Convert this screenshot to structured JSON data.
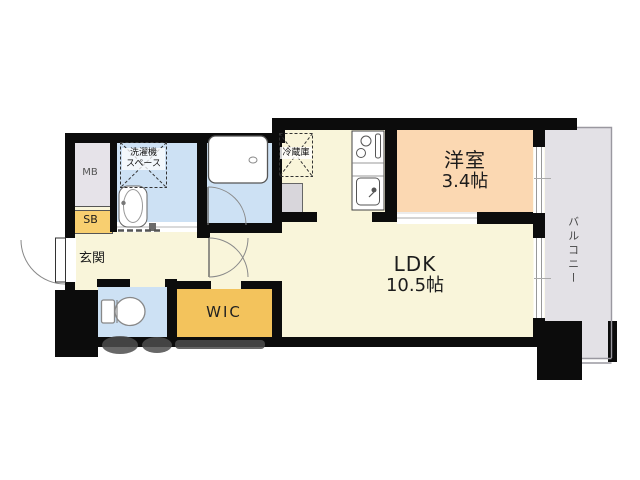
{
  "plan": {
    "type": "apartment-floorplan",
    "rooms": {
      "ldk": {
        "name": "LDK",
        "size": "10.5帖"
      },
      "western": {
        "name": "洋室",
        "size": "3.4帖"
      },
      "balcony": {
        "name": "バルコニー"
      },
      "wic": {
        "name": "WIC"
      },
      "entrance": {
        "name": "玄関"
      },
      "shoebox": {
        "name": "SB"
      },
      "meterbox": {
        "name": "MB"
      },
      "laundry": {
        "line1": "洗濯機",
        "line2": "スペース"
      },
      "fridge": {
        "name": "冷蔵庫"
      }
    },
    "colors": {
      "wall": "#0c0c0c",
      "floor_main": "#f9f5da",
      "room_wet": "#cde1f4",
      "room_western": "#fbd8b2",
      "balcony": "#e3e1e6",
      "wic": "#f3c35c",
      "shoebox": "#f8cf70",
      "meterbox": "#e6e3e9",
      "pipe_space": "#d8d6db",
      "outline": "#9a98a0"
    }
  }
}
